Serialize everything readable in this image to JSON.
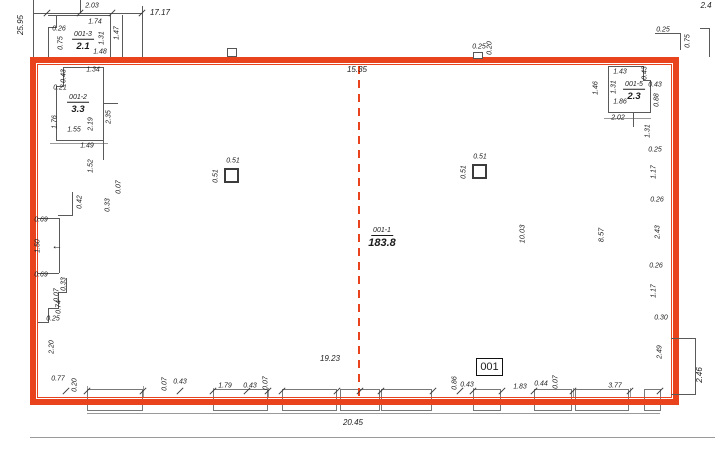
{
  "colors": {
    "wall_red": "#e8431d",
    "structure_line": "#5a5a5a",
    "dim_line": "#9a9a9a",
    "text": "#1c1c1c"
  },
  "rooms": [
    {
      "id": "001-3",
      "area": "2.1"
    },
    {
      "id": "001-2",
      "area": "3.3"
    },
    {
      "id": "001-5",
      "area": "2.3"
    },
    {
      "id": "001-1",
      "area": "183.8"
    }
  ],
  "badge": {
    "label": "001"
  },
  "icons": {
    "entrance_arrow": "←"
  },
  "dim_labels": [
    {
      "t": "25.95",
      "x": 21,
      "y": 25,
      "r": 1,
      "s": 8
    },
    {
      "t": "2.03",
      "x": 92,
      "y": 6
    },
    {
      "t": "17.17",
      "x": 160,
      "y": 13,
      "s": 8
    },
    {
      "t": "1.74",
      "x": 95,
      "y": 22
    },
    {
      "t": "0.26",
      "x": 59,
      "y": 29
    },
    {
      "t": "1.31",
      "x": 102,
      "y": 38,
      "r": 1
    },
    {
      "t": "1.47",
      "x": 117,
      "y": 33,
      "r": 1
    },
    {
      "t": "0.75",
      "x": 61,
      "y": 43,
      "r": 1
    },
    {
      "t": "1.48",
      "x": 100,
      "y": 52
    },
    {
      "t": "0.43",
      "x": 64,
      "y": 76,
      "r": 1
    },
    {
      "t": "1.34",
      "x": 93,
      "y": 70
    },
    {
      "t": "0.21",
      "x": 60,
      "y": 88
    },
    {
      "t": "1.76",
      "x": 55,
      "y": 122,
      "r": 1
    },
    {
      "t": "2.19",
      "x": 91,
      "y": 124,
      "r": 1
    },
    {
      "t": "2.35",
      "x": 109,
      "y": 117,
      "r": 1
    },
    {
      "t": "1.55",
      "x": 74,
      "y": 130
    },
    {
      "t": "1.49",
      "x": 87,
      "y": 146
    },
    {
      "t": "1.52",
      "x": 91,
      "y": 166,
      "r": 1
    },
    {
      "t": "0.07",
      "x": 119,
      "y": 187,
      "r": 1
    },
    {
      "t": "0.42",
      "x": 80,
      "y": 202,
      "r": 1
    },
    {
      "t": "0.33",
      "x": 108,
      "y": 205,
      "r": 1
    },
    {
      "t": "0.69",
      "x": 41,
      "y": 220
    },
    {
      "t": "1.50",
      "x": 38,
      "y": 246,
      "r": 1
    },
    {
      "t": "0.69",
      "x": 41,
      "y": 275
    },
    {
      "t": "0.33",
      "x": 64,
      "y": 284,
      "r": 1
    },
    {
      "t": "0.07",
      "x": 57,
      "y": 295,
      "r": 1
    },
    {
      "t": "0.74",
      "x": 59,
      "y": 307,
      "r": 1
    },
    {
      "t": "0.25",
      "x": 53,
      "y": 319
    },
    {
      "t": "2.20",
      "x": 52,
      "y": 347,
      "r": 1
    },
    {
      "t": "0.77",
      "x": 58,
      "y": 379
    },
    {
      "t": "0.20",
      "x": 75,
      "y": 385,
      "r": 1
    },
    {
      "t": "0.07",
      "x": 165,
      "y": 384,
      "r": 1
    },
    {
      "t": "0.43",
      "x": 180,
      "y": 382
    },
    {
      "t": "1.79",
      "x": 225,
      "y": 386
    },
    {
      "t": "0.43",
      "x": 250,
      "y": 386
    },
    {
      "t": "0.07",
      "x": 266,
      "y": 383,
      "r": 1
    },
    {
      "t": "19.23",
      "x": 330,
      "y": 359,
      "s": 8
    },
    {
      "t": "0.86",
      "x": 455,
      "y": 383,
      "r": 1
    },
    {
      "t": "0.43",
      "x": 467,
      "y": 385
    },
    {
      "t": "1.83",
      "x": 520,
      "y": 387
    },
    {
      "t": "0.44",
      "x": 541,
      "y": 384
    },
    {
      "t": "0.07",
      "x": 556,
      "y": 382,
      "r": 1
    },
    {
      "t": "3.77",
      "x": 615,
      "y": 386
    },
    {
      "t": "20.45",
      "x": 353,
      "y": 423,
      "s": 8
    },
    {
      "t": "15.35",
      "x": 357,
      "y": 70,
      "s": 8
    },
    {
      "t": "0.25",
      "x": 479,
      "y": 47
    },
    {
      "t": "0.20",
      "x": 490,
      "y": 48,
      "r": 1
    },
    {
      "t": "0.25",
      "x": 663,
      "y": 30
    },
    {
      "t": "0.75",
      "x": 688,
      "y": 41,
      "r": 1
    },
    {
      "t": "2.4",
      "x": 706,
      "y": 6,
      "s": 8
    },
    {
      "t": "1.43",
      "x": 620,
      "y": 72
    },
    {
      "t": "0.43",
      "x": 645,
      "y": 73,
      "r": 1
    },
    {
      "t": "1.46",
      "x": 596,
      "y": 88,
      "r": 1
    },
    {
      "t": "1.31",
      "x": 614,
      "y": 87,
      "r": 1
    },
    {
      "t": "0.43",
      "x": 655,
      "y": 85
    },
    {
      "t": "0.88",
      "x": 657,
      "y": 100,
      "r": 1
    },
    {
      "t": "1.86",
      "x": 620,
      "y": 102
    },
    {
      "t": "2.02",
      "x": 618,
      "y": 118
    },
    {
      "t": "1.31",
      "x": 648,
      "y": 131,
      "r": 1
    },
    {
      "t": "0.25",
      "x": 655,
      "y": 150
    },
    {
      "t": "1.17",
      "x": 654,
      "y": 172,
      "r": 1
    },
    {
      "t": "0.26",
      "x": 657,
      "y": 200
    },
    {
      "t": "2.43",
      "x": 658,
      "y": 232,
      "r": 1
    },
    {
      "t": "0.26",
      "x": 656,
      "y": 266
    },
    {
      "t": "1.17",
      "x": 654,
      "y": 291,
      "r": 1
    },
    {
      "t": "0.30",
      "x": 661,
      "y": 318
    },
    {
      "t": "2.49",
      "x": 660,
      "y": 352,
      "r": 1
    },
    {
      "t": "2.46",
      "x": 700,
      "y": 375,
      "r": 1,
      "s": 8
    },
    {
      "t": "10.03",
      "x": 522,
      "y": 234,
      "r": 1,
      "s": 7.5
    },
    {
      "t": "8.57",
      "x": 601,
      "y": 235,
      "r": 1,
      "s": 7.5
    },
    {
      "t": "0.51",
      "x": 233,
      "y": 161
    },
    {
      "t": "0.51",
      "x": 216,
      "y": 176,
      "r": 1
    },
    {
      "t": "0.51",
      "x": 480,
      "y": 157
    },
    {
      "t": "0.51",
      "x": 464,
      "y": 172,
      "r": 1
    }
  ]
}
